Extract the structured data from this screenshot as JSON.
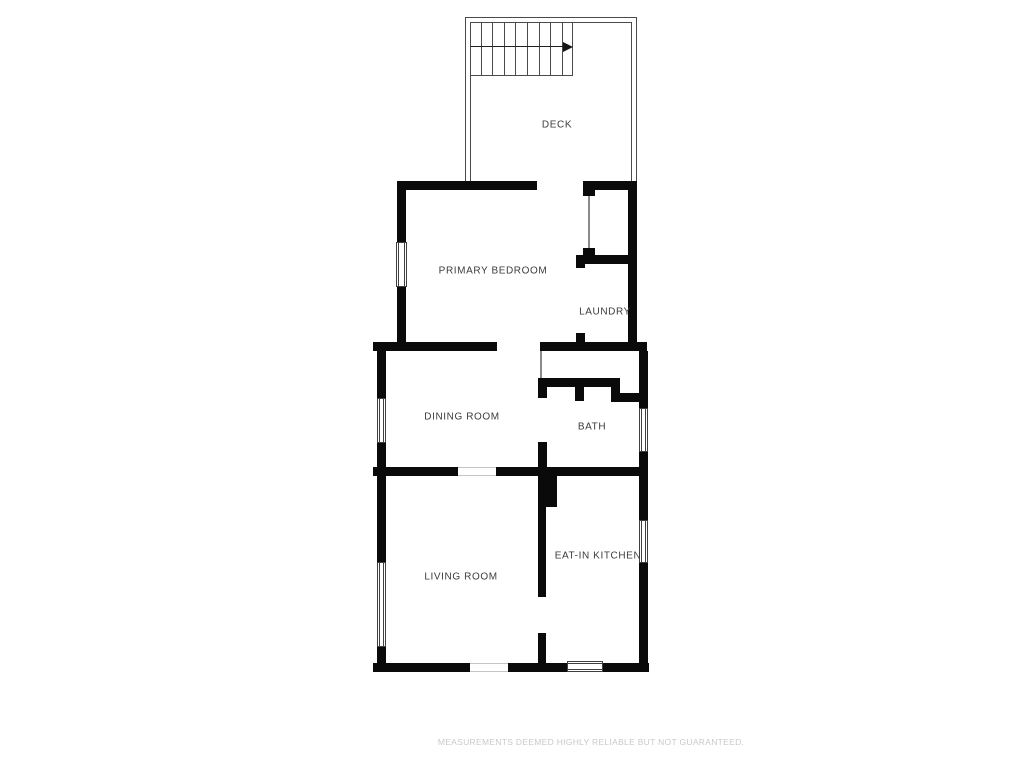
{
  "floor_plan": {
    "rooms": {
      "deck": "DECK",
      "primary_bedroom": "PRIMARY BEDROOM",
      "laundry": "LAUNDRY",
      "dining_room": "DINING ROOM",
      "bath": "BATH",
      "living_room": "LIVING ROOM",
      "eat_in_kitchen": "EAT-IN KITCHEN"
    },
    "stairs": {
      "treads": 9,
      "arrow_direction": "right"
    },
    "windows": [
      "bedroom-left",
      "dining-left",
      "bath-right",
      "kitchen-right",
      "living-left",
      "kitchen-bottom"
    ],
    "colors": {
      "wall": "#0a0a0a",
      "deck_line": "#4a4a4a",
      "label": "#3b3b3b",
      "disclaimer": "#c9c9c9"
    }
  },
  "footer": {
    "disclaimer": "MEASUREMENTS DEEMED HIGHLY RELIABLE BUT NOT GUARANTEED."
  }
}
